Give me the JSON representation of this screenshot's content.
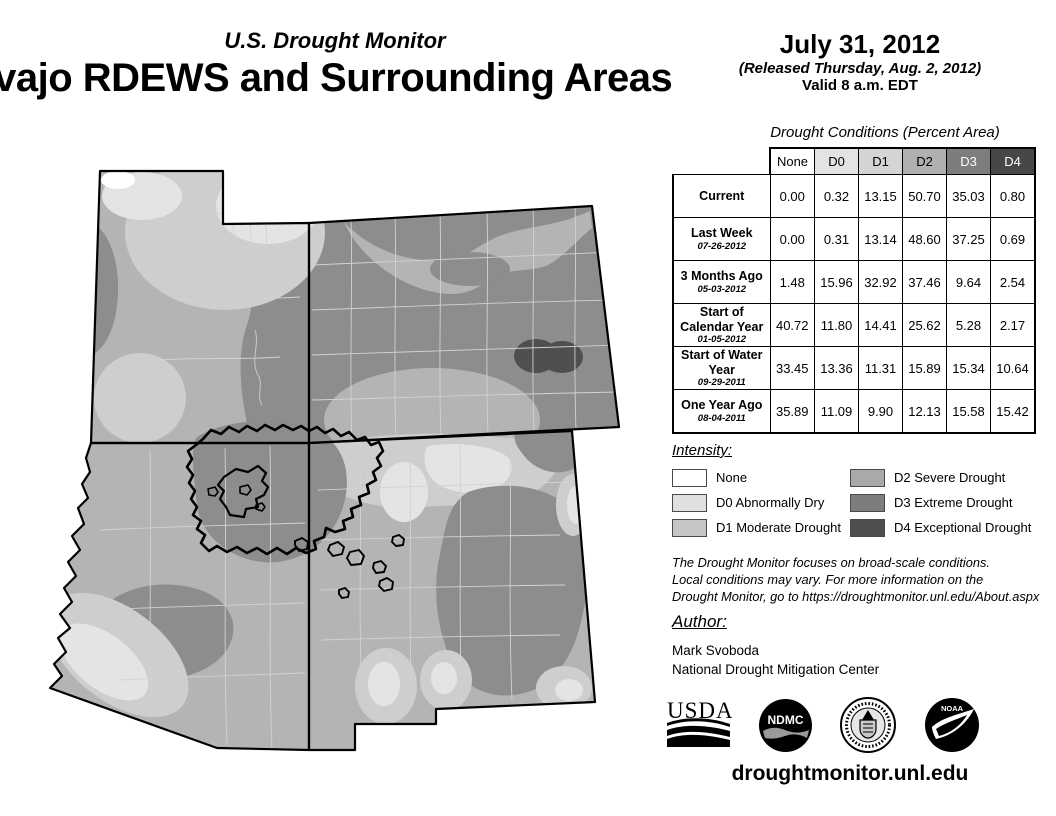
{
  "header": {
    "monitor_title": "U.S. Drought Monitor",
    "map_title": "Navajo RDEWS and Surrounding Areas",
    "date": "July 31, 2012",
    "released": "(Released Thursday, Aug. 2, 2012)",
    "valid": "Valid 8 a.m. EDT"
  },
  "table": {
    "title": "Drought Conditions (Percent Area)",
    "columns": [
      "None",
      "D0",
      "D1",
      "D2",
      "D3",
      "D4"
    ],
    "column_styles": [
      {
        "bg": "#ffffff",
        "fg": "#000000"
      },
      {
        "bg": "#e3e3e3",
        "fg": "#000000"
      },
      {
        "bg": "#d4d4d4",
        "fg": "#000000"
      },
      {
        "bg": "#b0b0b0",
        "fg": "#000000"
      },
      {
        "bg": "#7d7d7d",
        "fg": "#ffffff"
      },
      {
        "bg": "#474747",
        "fg": "#ffffff"
      }
    ],
    "rows": [
      {
        "label": "Current",
        "date": "",
        "values": [
          "0.00",
          "0.32",
          "13.15",
          "50.70",
          "35.03",
          "0.80"
        ]
      },
      {
        "label": "Last Week",
        "date": "07-26-2012",
        "values": [
          "0.00",
          "0.31",
          "13.14",
          "48.60",
          "37.25",
          "0.69"
        ]
      },
      {
        "label": "3 Months Ago",
        "date": "05-03-2012",
        "values": [
          "1.48",
          "15.96",
          "32.92",
          "37.46",
          "9.64",
          "2.54"
        ]
      },
      {
        "label": "Start of Calendar Year",
        "date": "01-05-2012",
        "values": [
          "40.72",
          "11.80",
          "14.41",
          "25.62",
          "5.28",
          "2.17"
        ]
      },
      {
        "label": "Start of Water Year",
        "date": "09-29-2011",
        "values": [
          "33.45",
          "13.36",
          "11.31",
          "15.89",
          "15.34",
          "10.64"
        ]
      },
      {
        "label": "One Year Ago",
        "date": "08-04-2011",
        "values": [
          "35.89",
          "11.09",
          "9.90",
          "12.13",
          "15.58",
          "15.42"
        ]
      }
    ]
  },
  "legend": {
    "title": "Intensity:",
    "items": [
      {
        "label": "None",
        "color": "#ffffff"
      },
      {
        "label": "D0 Abnormally Dry",
        "color": "#e0e0e0"
      },
      {
        "label": "D1 Moderate Drought",
        "color": "#c6c6c6"
      },
      {
        "label": "D2 Severe Drought",
        "color": "#a9a9a9"
      },
      {
        "label": "D3 Extreme Drought",
        "color": "#7d7d7d"
      },
      {
        "label": "D4 Exceptional Drought",
        "color": "#4e4e4e"
      }
    ]
  },
  "disclaimer": {
    "lines": [
      "The Drought Monitor focuses on broad-scale conditions.",
      "Local conditions may vary. For more information on the",
      "Drought Monitor, go to https://droughtmonitor.unl.edu/About.aspx"
    ]
  },
  "author": {
    "title": "Author:",
    "name": "Mark Svoboda",
    "org": "National Drought Mitigation Center"
  },
  "footer": {
    "url": "droughtmonitor.unl.edu",
    "logo_texts": {
      "usda": "USDA",
      "ndmc": "NDMC",
      "noaa": "NOAA"
    }
  },
  "map": {
    "states": [
      "Utah",
      "Colorado",
      "Arizona",
      "New Mexico"
    ],
    "boundaries": [
      "Navajo Nation",
      "Hopi Reservation"
    ],
    "palette": {
      "none": "#ffffff",
      "d0": "#e4e4e4",
      "d1": "#cecece",
      "d2": "#b4b4b4",
      "d3": "#8d8d8d",
      "d4": "#4f4f4f"
    }
  }
}
